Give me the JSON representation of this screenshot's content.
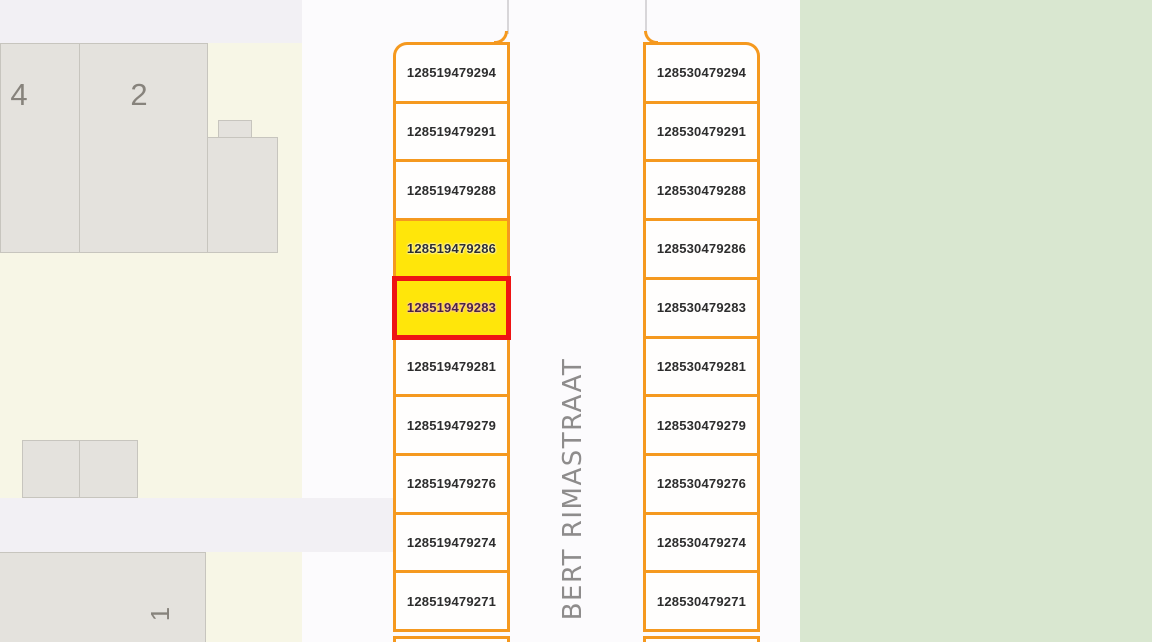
{
  "map": {
    "street": {
      "label": "BERT RIMASTRAAT"
    },
    "buildings": [
      {
        "label": "4"
      },
      {
        "label": "2"
      },
      {
        "label": "1"
      }
    ],
    "bays": {
      "left": {
        "cells": [
          "128519479294",
          "128519479291",
          "128519479288",
          "128519479286",
          "128519479283",
          "128519479281",
          "128519479279",
          "128519479276",
          "128519479274",
          "128519479271"
        ]
      },
      "right": {
        "cells": [
          "128530479294",
          "128530479291",
          "128530479288",
          "128530479286",
          "128530479283",
          "128530479281",
          "128530479279",
          "128530479276",
          "128530479274",
          "128530479271"
        ]
      }
    },
    "selection": {
      "selected_bay": "128519479283",
      "highlighted_bay": "128519479286"
    },
    "colors": {
      "bay_border": "#f5991f",
      "bay_fill": "#fffefd",
      "highlight_fill": "#ffe60a",
      "selected_border": "#ee1414",
      "green_area": "#d9e7d0",
      "parcel_cream": "#f7f6e6",
      "building_gray": "#e4e2dd",
      "road_lavender": "#f2f0f4"
    }
  }
}
